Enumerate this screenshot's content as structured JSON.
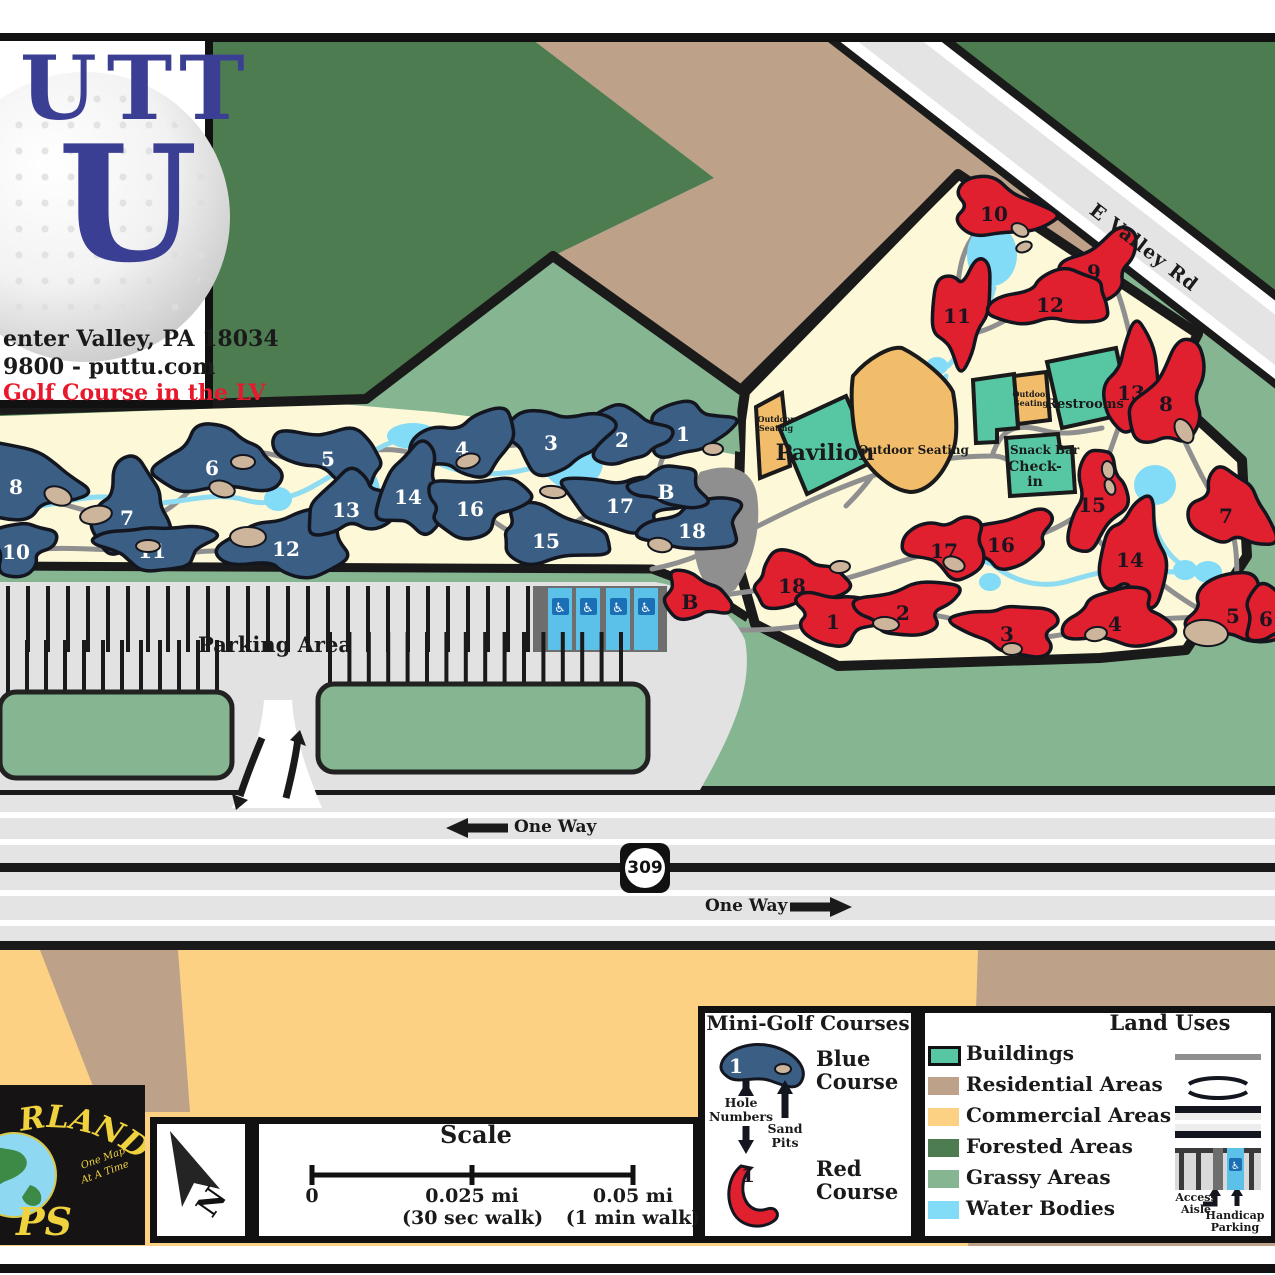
{
  "logo_card": {
    "brand_top": "UTT",
    "brand_u": "U",
    "address_line": "enter Valley, PA 18034",
    "contact_line": "9800 - puttu.com",
    "tagline": "Golf Course in the LV"
  },
  "map": {
    "road_name": "E Valley Rd",
    "route_shield": "309",
    "one_way": "One Way",
    "parking_label": "Parking Area",
    "buildings": {
      "pavilion": "Pavilion",
      "outdoor_seating_small": "Outdoor Seating",
      "outdoor_seating_main": "Outdoor Seating",
      "outdoor_seating_upper": "Outdoor Seating",
      "restrooms": "Restrooms",
      "snack_bar": "Snack Bar",
      "check_in": "Check-in"
    },
    "blue_holes": [
      {
        "n": "1",
        "x": 683,
        "y": 434,
        "rx": 42,
        "ry": 24,
        "rot": -12,
        "s": 1
      },
      {
        "n": "2",
        "x": 622,
        "y": 440,
        "rx": 40,
        "ry": 26,
        "rot": 8,
        "s": 2
      },
      {
        "n": "3",
        "x": 551,
        "y": 443,
        "rx": 52,
        "ry": 30,
        "rot": 4,
        "s": 3
      },
      {
        "n": "4",
        "x": 462,
        "y": 449,
        "rx": 50,
        "ry": 30,
        "rot": -8,
        "s": 4
      },
      {
        "n": "5",
        "x": 328,
        "y": 459,
        "rx": 52,
        "ry": 26,
        "rot": 12,
        "s": 5
      },
      {
        "n": "6",
        "x": 212,
        "y": 468,
        "rx": 58,
        "ry": 33,
        "rot": -6,
        "s": 6
      },
      {
        "n": "7",
        "x": 127,
        "y": 518,
        "rx": 40,
        "ry": 44,
        "rot": 15,
        "s": 7
      },
      {
        "n": "8",
        "x": 16,
        "y": 487,
        "rx": 58,
        "ry": 34,
        "rot": 8,
        "s": 8
      },
      {
        "n": "10",
        "x": 16,
        "y": 552,
        "rx": 30,
        "ry": 26,
        "rot": 0,
        "s": 9
      },
      {
        "n": "11",
        "x": 152,
        "y": 551,
        "rx": 52,
        "ry": 23,
        "rot": 3,
        "s": 10
      },
      {
        "n": "12",
        "x": 286,
        "y": 549,
        "rx": 58,
        "ry": 34,
        "rot": -4,
        "s": 11
      },
      {
        "n": "13",
        "x": 346,
        "y": 510,
        "rx": 42,
        "ry": 30,
        "rot": -18,
        "s": 12
      },
      {
        "n": "14",
        "x": 408,
        "y": 497,
        "rx": 34,
        "ry": 40,
        "rot": 20,
        "s": 13
      },
      {
        "n": "15",
        "x": 546,
        "y": 541,
        "rx": 58,
        "ry": 25,
        "rot": 6,
        "s": 14
      },
      {
        "n": "16",
        "x": 470,
        "y": 509,
        "rx": 52,
        "ry": 27,
        "rot": -5,
        "s": 15
      },
      {
        "n": "17",
        "x": 620,
        "y": 506,
        "rx": 58,
        "ry": 27,
        "rot": 6,
        "s": 16
      },
      {
        "n": "18",
        "x": 692,
        "y": 531,
        "rx": 46,
        "ry": 26,
        "rot": -10,
        "s": 17
      },
      {
        "n": "B",
        "x": 666,
        "y": 492,
        "rx": 34,
        "ry": 21,
        "rot": 4,
        "s": 18
      }
    ],
    "red_holes": [
      {
        "n": "10",
        "x": 994,
        "y": 214,
        "rx": 52,
        "ry": 25,
        "rot": 18,
        "s": 21
      },
      {
        "n": "9",
        "x": 1094,
        "y": 272,
        "rx": 44,
        "ry": 26,
        "rot": -28,
        "s": 22
      },
      {
        "n": "11",
        "x": 957,
        "y": 316,
        "rx": 26,
        "ry": 52,
        "rot": 8,
        "s": 23
      },
      {
        "n": "12",
        "x": 1050,
        "y": 305,
        "rx": 55,
        "ry": 27,
        "rot": -10,
        "s": 24
      },
      {
        "n": "13",
        "x": 1131,
        "y": 393,
        "rx": 28,
        "ry": 55,
        "rot": 6,
        "s": 25
      },
      {
        "n": "8",
        "x": 1166,
        "y": 404,
        "rx": 32,
        "ry": 52,
        "rot": 32,
        "s": 26
      },
      {
        "n": "15",
        "x": 1092,
        "y": 505,
        "rx": 26,
        "ry": 48,
        "rot": 12,
        "s": 27
      },
      {
        "n": "7",
        "x": 1226,
        "y": 516,
        "rx": 42,
        "ry": 34,
        "rot": 55,
        "s": 28
      },
      {
        "n": "16",
        "x": 1001,
        "y": 545,
        "rx": 46,
        "ry": 26,
        "rot": -8,
        "s": 29
      },
      {
        "n": "17",
        "x": 944,
        "y": 551,
        "rx": 38,
        "ry": 30,
        "rot": 10,
        "s": 30
      },
      {
        "n": "14",
        "x": 1130,
        "y": 560,
        "rx": 32,
        "ry": 50,
        "rot": 8,
        "s": 31
      },
      {
        "n": "18",
        "x": 792,
        "y": 586,
        "rx": 48,
        "ry": 25,
        "rot": -8,
        "s": 32
      },
      {
        "n": "B",
        "x": 690,
        "y": 602,
        "rx": 36,
        "ry": 20,
        "rot": 12,
        "s": 33
      },
      {
        "n": "1",
        "x": 833,
        "y": 622,
        "rx": 46,
        "ry": 24,
        "rot": 6,
        "s": 34
      },
      {
        "n": "2",
        "x": 903,
        "y": 613,
        "rx": 46,
        "ry": 26,
        "rot": -6,
        "s": 35
      },
      {
        "n": "3",
        "x": 1007,
        "y": 634,
        "rx": 46,
        "ry": 26,
        "rot": 8,
        "s": 36
      },
      {
        "n": "4",
        "x": 1115,
        "y": 624,
        "rx": 48,
        "ry": 30,
        "rot": -4,
        "s": 37
      },
      {
        "n": "5",
        "x": 1233,
        "y": 616,
        "rx": 52,
        "ry": 32,
        "rot": 4,
        "s": 38
      },
      {
        "n": "6",
        "x": 1266,
        "y": 619,
        "rx": 30,
        "ry": 24,
        "rot": 0,
        "s": 39
      }
    ],
    "sand_pits": [
      [
        58,
        496,
        14,
        9,
        20
      ],
      [
        96,
        515,
        16,
        9,
        -10
      ],
      [
        222,
        489,
        13,
        8,
        15
      ],
      [
        243,
        462,
        12,
        7,
        0
      ],
      [
        468,
        461,
        12,
        7,
        -15
      ],
      [
        553,
        492,
        13,
        6,
        5
      ],
      [
        660,
        545,
        12,
        7,
        10
      ],
      [
        713,
        449,
        10,
        6,
        0
      ],
      [
        148,
        546,
        12,
        6,
        0
      ],
      [
        248,
        537,
        18,
        10,
        0
      ],
      [
        1020,
        230,
        9,
        6,
        30
      ],
      [
        1024,
        247,
        8,
        5,
        -20
      ],
      [
        1184,
        431,
        13,
        8,
        60
      ],
      [
        1108,
        470,
        9,
        6,
        80
      ],
      [
        1110,
        487,
        8,
        5,
        70
      ],
      [
        954,
        564,
        11,
        7,
        20
      ],
      [
        886,
        624,
        13,
        7,
        5
      ],
      [
        1012,
        649,
        10,
        6,
        0
      ],
      [
        1096,
        634,
        11,
        7,
        -10
      ],
      [
        1206,
        633,
        22,
        13,
        5
      ],
      [
        840,
        567,
        10,
        6,
        -5
      ]
    ]
  },
  "attribution": {
    "brand_arc": "RLAND",
    "brand_bottom": "PS",
    "tagline_1": "One Map",
    "tagline_2": "At A Time"
  },
  "north_label": "N",
  "scale_box": {
    "title": "Scale",
    "t0": "0",
    "t1": "0.025 mi",
    "t1_sub": "(30 sec walk)",
    "t2": "0.05 mi",
    "t2_sub": "(1 min walk)"
  },
  "legend_courses": {
    "title": "Mini-Golf Courses",
    "sample_number": "1",
    "blue": "Blue Course",
    "red": "Red Course",
    "hole_numbers": "Hole Numbers",
    "sand_pits": "Sand Pits"
  },
  "legend_land": {
    "title": "Land Uses",
    "items": [
      {
        "label": "Buildings",
        "color": "#57c7a3"
      },
      {
        "label": "Residential Areas",
        "color": "#bda189"
      },
      {
        "label": "Commercial Areas",
        "color": "#fcd183"
      },
      {
        "label": "Forested Areas",
        "color": "#4d7c50"
      },
      {
        "label": "Grassy Areas",
        "color": "#86b691"
      },
      {
        "label": "Water Bodies",
        "color": "#82dbf7"
      }
    ],
    "access_aisle": "Access Aisle",
    "handicap_parking": "Handicap Parking"
  },
  "colors": {
    "blue_course": "#3a5e84",
    "red_course": "#e0202e",
    "sand": "#cdb59c",
    "water": "#82dbf7",
    "forest": "#4d7c50",
    "grass": "#86b691",
    "residential": "#bda189",
    "commercial": "#fcd183",
    "building": "#57c7a3",
    "seating_orange": "#f2bd6b"
  }
}
